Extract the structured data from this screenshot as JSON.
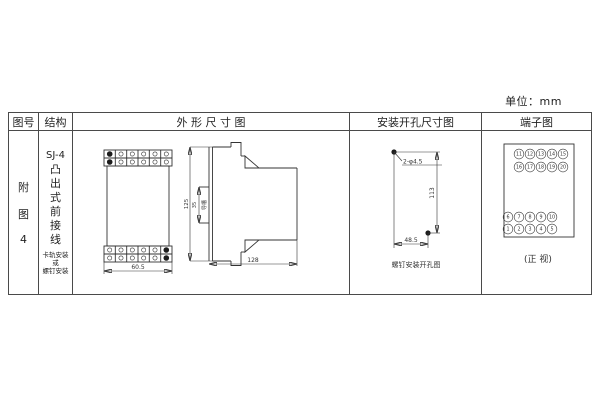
{
  "unit_label": "单位：mm",
  "table_headers": {
    "figure_no": "图号",
    "structure": "结构",
    "outline": "外 形 尺 寸 图",
    "mounting": "安装开孔尺寸图",
    "terminal": "端子图"
  },
  "figure_label": {
    "chars": [
      "附",
      "图",
      "4"
    ]
  },
  "structure_col": {
    "model": "SJ-4",
    "type_chars": [
      "凸",
      "出",
      "式",
      "前",
      "接",
      "线"
    ],
    "note_lines": [
      "卡轨安装",
      "或",
      "螺钉安装"
    ]
  },
  "outline_view": {
    "front_width": "60.5",
    "height": "125",
    "groove_dim": "35",
    "groove_label": "导槽",
    "depth": "128"
  },
  "mounting_view": {
    "holes_label": "2-φ4.5",
    "vertical_spacing": "113",
    "horizontal_spacing": "48.5",
    "caption": "螺钉安装开孔图"
  },
  "terminal_view": {
    "rows": [
      [
        "11",
        "12",
        "13",
        "14",
        "15"
      ],
      [
        "16",
        "17",
        "18",
        "19",
        "20"
      ],
      [
        "6",
        "7",
        "8",
        "9",
        "10"
      ],
      [
        "1",
        "2",
        "3",
        "4",
        "5"
      ]
    ],
    "caption": "(正 视)"
  },
  "colors": {
    "line": "#333333",
    "border": "#4a4a4a",
    "background": "#ffffff"
  }
}
